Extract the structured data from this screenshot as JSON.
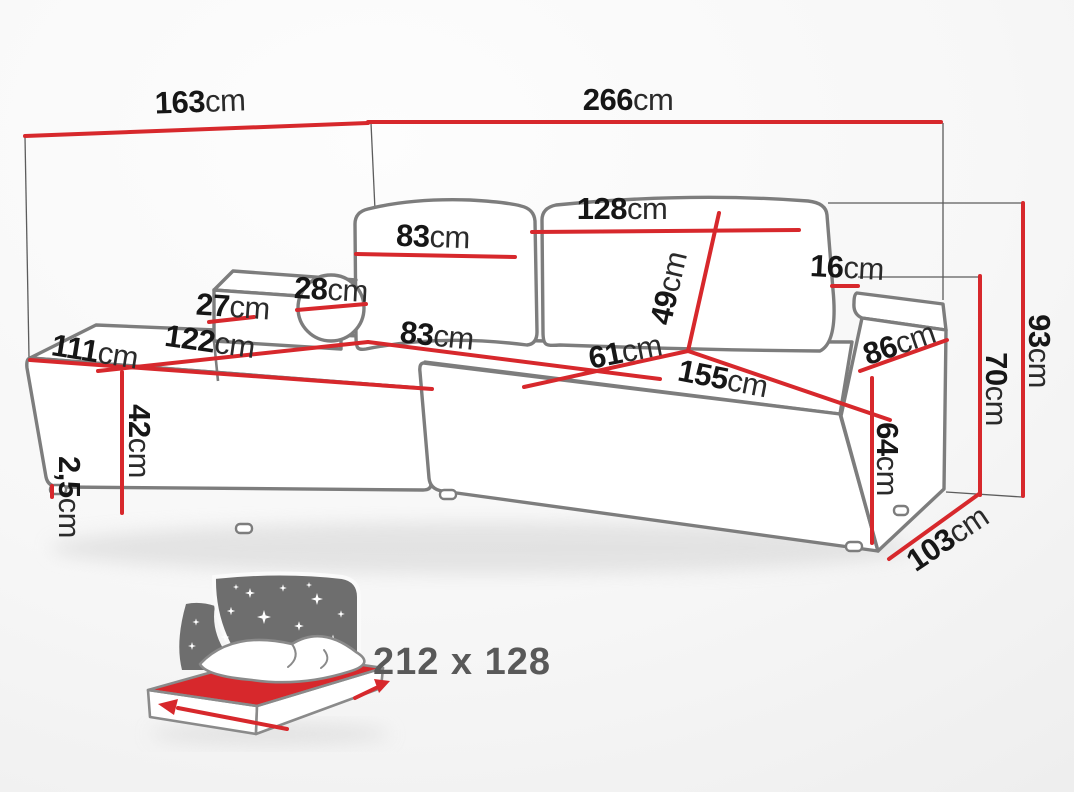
{
  "title": "corner-sofa-dimension-diagram",
  "unit_default": "cm",
  "colors": {
    "dimension_line": "#d7282c",
    "sofa_outline": "#7d7d7d",
    "label_text": "#1b1b1b",
    "sleeping_text": "#595959"
  },
  "dims": {
    "w163": {
      "num": "163",
      "unit": "cm"
    },
    "w266": {
      "num": "266",
      "unit": "cm"
    },
    "w128": {
      "num": "128",
      "unit": "cm"
    },
    "back83": {
      "num": "83",
      "unit": "cm"
    },
    "pillow28": {
      "num": "28",
      "unit": "cm"
    },
    "arm27": {
      "num": "27",
      "unit": "cm"
    },
    "chaise111": {
      "num": "111",
      "unit": "cm"
    },
    "chaise122": {
      "num": "122",
      "unit": "cm"
    },
    "seat83": {
      "num": "83",
      "unit": "cm"
    },
    "seat61": {
      "num": "61",
      "unit": "cm"
    },
    "seat155": {
      "num": "155",
      "unit": "cm"
    },
    "back49": {
      "num": "49",
      "unit": "cm"
    },
    "arm16": {
      "num": "16",
      "unit": "cm"
    },
    "arm86": {
      "num": "86",
      "unit": "cm"
    },
    "arm64": {
      "num": "64",
      "unit": "cm"
    },
    "h70": {
      "num": "70",
      "unit": "cm"
    },
    "h93": {
      "num": "93",
      "unit": "cm"
    },
    "h42": {
      "num": "42",
      "unit": "cm"
    },
    "leg2_5": {
      "num": "2,5",
      "unit": "cm"
    },
    "d103": {
      "num": "103",
      "unit": "cm"
    }
  },
  "sleeping": {
    "label": "212 x 128",
    "icon": "bed-sleeping-function-icon"
  }
}
